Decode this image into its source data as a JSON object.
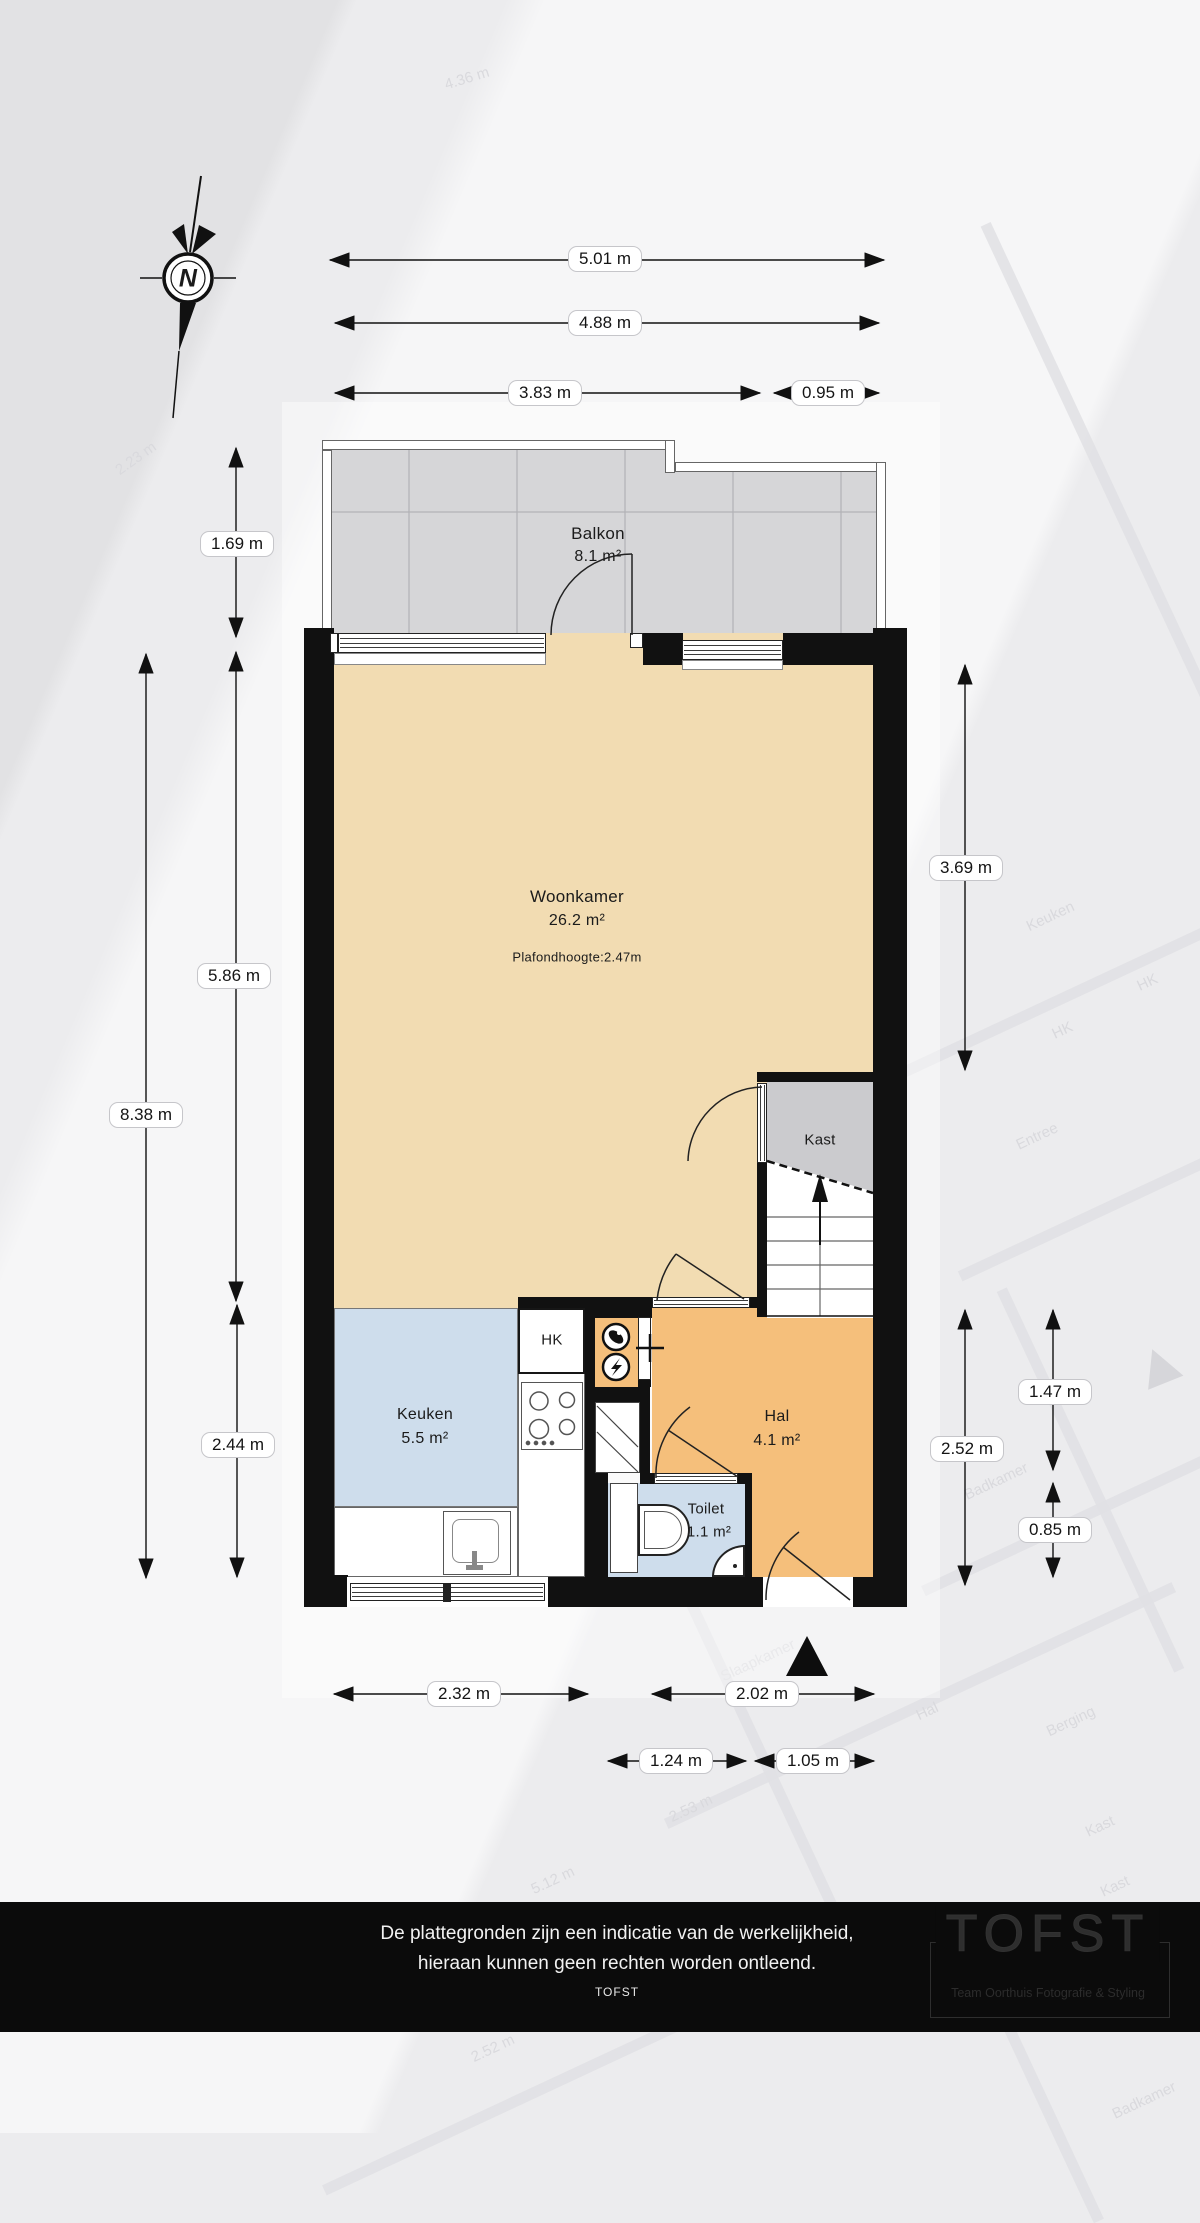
{
  "compass": {
    "north": "N"
  },
  "rooms": {
    "balkon": {
      "name": "Balkon",
      "area": "8.1 m²"
    },
    "woonkamer": {
      "name": "Woonkamer",
      "area": "26.2 m²",
      "ceiling": "Plafondhoogte:2.47m"
    },
    "kast": {
      "name": "Kast"
    },
    "keuken": {
      "name": "Keuken",
      "area": "5.5 m²"
    },
    "hal": {
      "name": "Hal",
      "area": "4.1 m²"
    },
    "toilet": {
      "name": "Toilet",
      "area": "1.1 m²"
    },
    "meterkast": {
      "label": "HK"
    }
  },
  "dims": {
    "top": [
      "5.01 m",
      "4.88 m",
      "3.83 m",
      "0.95 m"
    ],
    "left": [
      "1.69 m",
      "5.86 m",
      "8.38 m",
      "2.44 m"
    ],
    "right": [
      "3.69 m",
      "2.52 m",
      "1.47 m",
      "0.85 m"
    ],
    "bottom": [
      "2.32 m",
      "2.02 m",
      "1.24 m",
      "1.05 m"
    ]
  },
  "watermark": {
    "labels": [
      "4.36 m",
      "2.23 m",
      "Keuken",
      "HK",
      "HK",
      "Entree",
      "Badkamer",
      "Slaapkamer",
      "Hal",
      "Berging",
      "Kast",
      "2.53 m",
      "5.12 m",
      "2.52 m",
      "Badkamer",
      "Kast"
    ]
  },
  "footer": {
    "disclaimer1": "De plattegronden zijn een indicatie van de werkelijkheid,",
    "disclaimer2": "hieraan kunnen geen rechten worden ontleend.",
    "brand": "TOFST",
    "logo_title": "TOFST",
    "logo_subtitle": "Team Oorthuis Fotografie & Styling"
  },
  "colors": {
    "wall": "#111111",
    "woonkamer": "#F2DCB2",
    "hal": "#F5BF7B",
    "keuken": "#CEDDEC",
    "balkon": "#D6D6D8",
    "kast": "#CBCBCE",
    "footerbg": "#0B0B0B",
    "pagebg": "#ECECEE"
  }
}
